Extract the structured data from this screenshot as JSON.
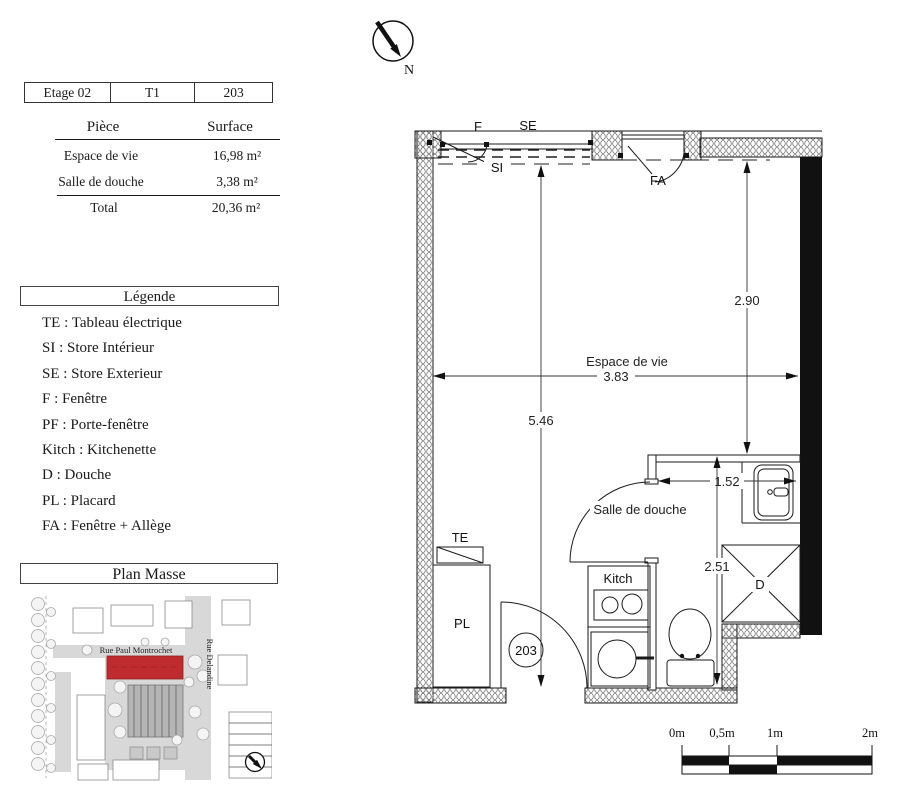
{
  "info_table": {
    "cells": [
      "Etage 02",
      "T1",
      "203"
    ]
  },
  "surface_table": {
    "header": {
      "piece": "Pièce",
      "surface": "Surface"
    },
    "rows": [
      {
        "piece": "Espace de vie",
        "surface": "16,98 m²"
      },
      {
        "piece": "Salle de douche",
        "surface": "3,38 m²"
      }
    ],
    "total": {
      "label": "Total",
      "value": "20,36 m²"
    }
  },
  "legende": {
    "title": "Légende",
    "items": [
      "TE : Tableau électrique",
      "SI : Store Intérieur",
      "SE : Store Exterieur",
      "F : Fenêtre",
      "PF : Porte-fenêtre",
      "Kitch : Kitchenette",
      "D : Douche",
      "PL : Placard",
      "FA : Fenêtre + Allège"
    ]
  },
  "plan_masse": {
    "title": "Plan Masse",
    "street_horizontal": "Rue Paul Montrochet",
    "street_vertical": "Rue Delandine",
    "highlight_color": "#bf2b2e"
  },
  "north_arrow": {
    "label": "N"
  },
  "floor_plan": {
    "room_number": "203",
    "labels": {
      "window": "F",
      "store_exterieur": "SE",
      "store_interieur": "SI",
      "fenetre_allege": "FA",
      "tableau_electrique": "TE",
      "placard": "PL",
      "kitchenette": "Kitch",
      "douche": "D",
      "living": "Espace de vie",
      "bathroom": "Salle de douche"
    },
    "dimensions": {
      "living_width": "3.83",
      "living_height": "2.90",
      "total_height": "5.46",
      "bath_width": "1.52",
      "bath_height": "2.51"
    }
  },
  "scale_bar": {
    "ticks": [
      "0m",
      "0,5m",
      "1m",
      "2m"
    ]
  }
}
